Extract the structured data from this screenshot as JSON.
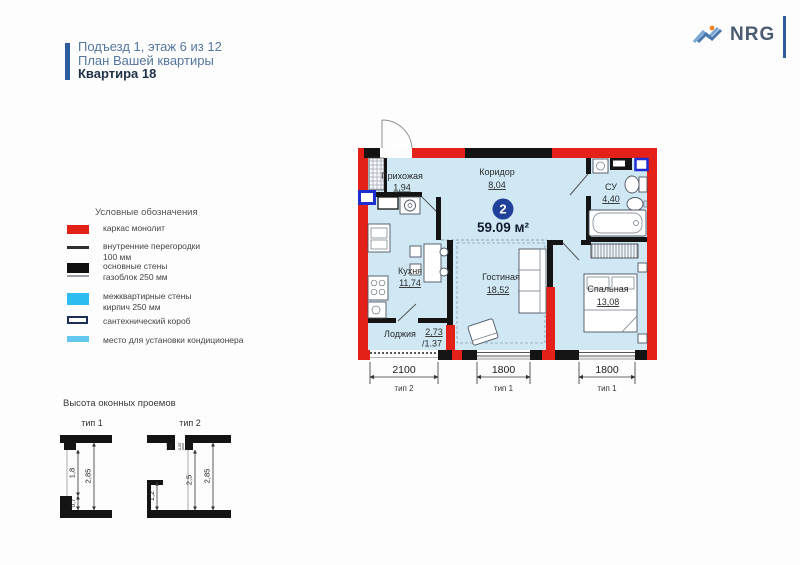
{
  "header": {
    "line1": "Подъезд 1, этаж 6 из 12",
    "line2": "План Вашей квартиры",
    "line3": "Квартира 18"
  },
  "logo": {
    "name": "NRG"
  },
  "legend": {
    "title": "Условные обозначения",
    "items": [
      {
        "swatch": "red-solid",
        "label": "каркас монолит"
      },
      {
        "swatch": "thin-dark-line",
        "label": "внутренние перегородки",
        "label2": "100 мм"
      },
      {
        "swatch": "black-solid",
        "label": "основные стены",
        "label2": "газоблок 250 мм"
      },
      {
        "swatch": "cyan-solid",
        "label": "межквартирные стены",
        "label2": "кирпич 250 мм"
      },
      {
        "swatch": "navy-outline",
        "label": "сантехнический короб"
      },
      {
        "swatch": "lightblue-solid",
        "label": "место для установки кондиционера"
      }
    ]
  },
  "plan": {
    "badge": "2",
    "total_area": "59.09 м²",
    "rooms": {
      "hallway": {
        "name": "Прихожая",
        "area": "1,94"
      },
      "corridor": {
        "name": "Коридор",
        "area": "8,04"
      },
      "bathroom": {
        "name": "СУ",
        "area": "4,40"
      },
      "kitchen": {
        "name": "Кухня",
        "area": "11,74"
      },
      "living": {
        "name": "Гостиная",
        "area": "18,52"
      },
      "bedroom": {
        "name": "Спальная",
        "area": "13,08"
      },
      "loggia": {
        "name": "Лоджия",
        "area": "2,73",
        "area_reduced": "/1.37"
      }
    },
    "window_dims": [
      {
        "width": "2100",
        "type": "тип 2"
      },
      {
        "width": "1800",
        "type": "тип 1"
      },
      {
        "width": "1800",
        "type": "тип 1"
      }
    ]
  },
  "window_heights": {
    "title": "Высота оконных проемов",
    "type1_label": "тип 1",
    "type2_label": "тип 2",
    "type1": {
      "total": "2,85",
      "opening": "1,8",
      "sill": "0,7"
    },
    "type2": {
      "total": "2,85",
      "opening": "2,5",
      "sill": "1,2",
      "header": "0,35"
    }
  },
  "colors": {
    "frame_red": "#e32119",
    "wall_black": "#141414",
    "interapartment_cyan": "#2ebdf0",
    "plumbing_navy": "#1c2e54",
    "ac_lightblue": "#63c7ef",
    "room_fill": "#cfe8f4",
    "badge_navy": "#21409a",
    "accent_blue": "#2e5d9f",
    "logo_orange": "#f4831f"
  }
}
